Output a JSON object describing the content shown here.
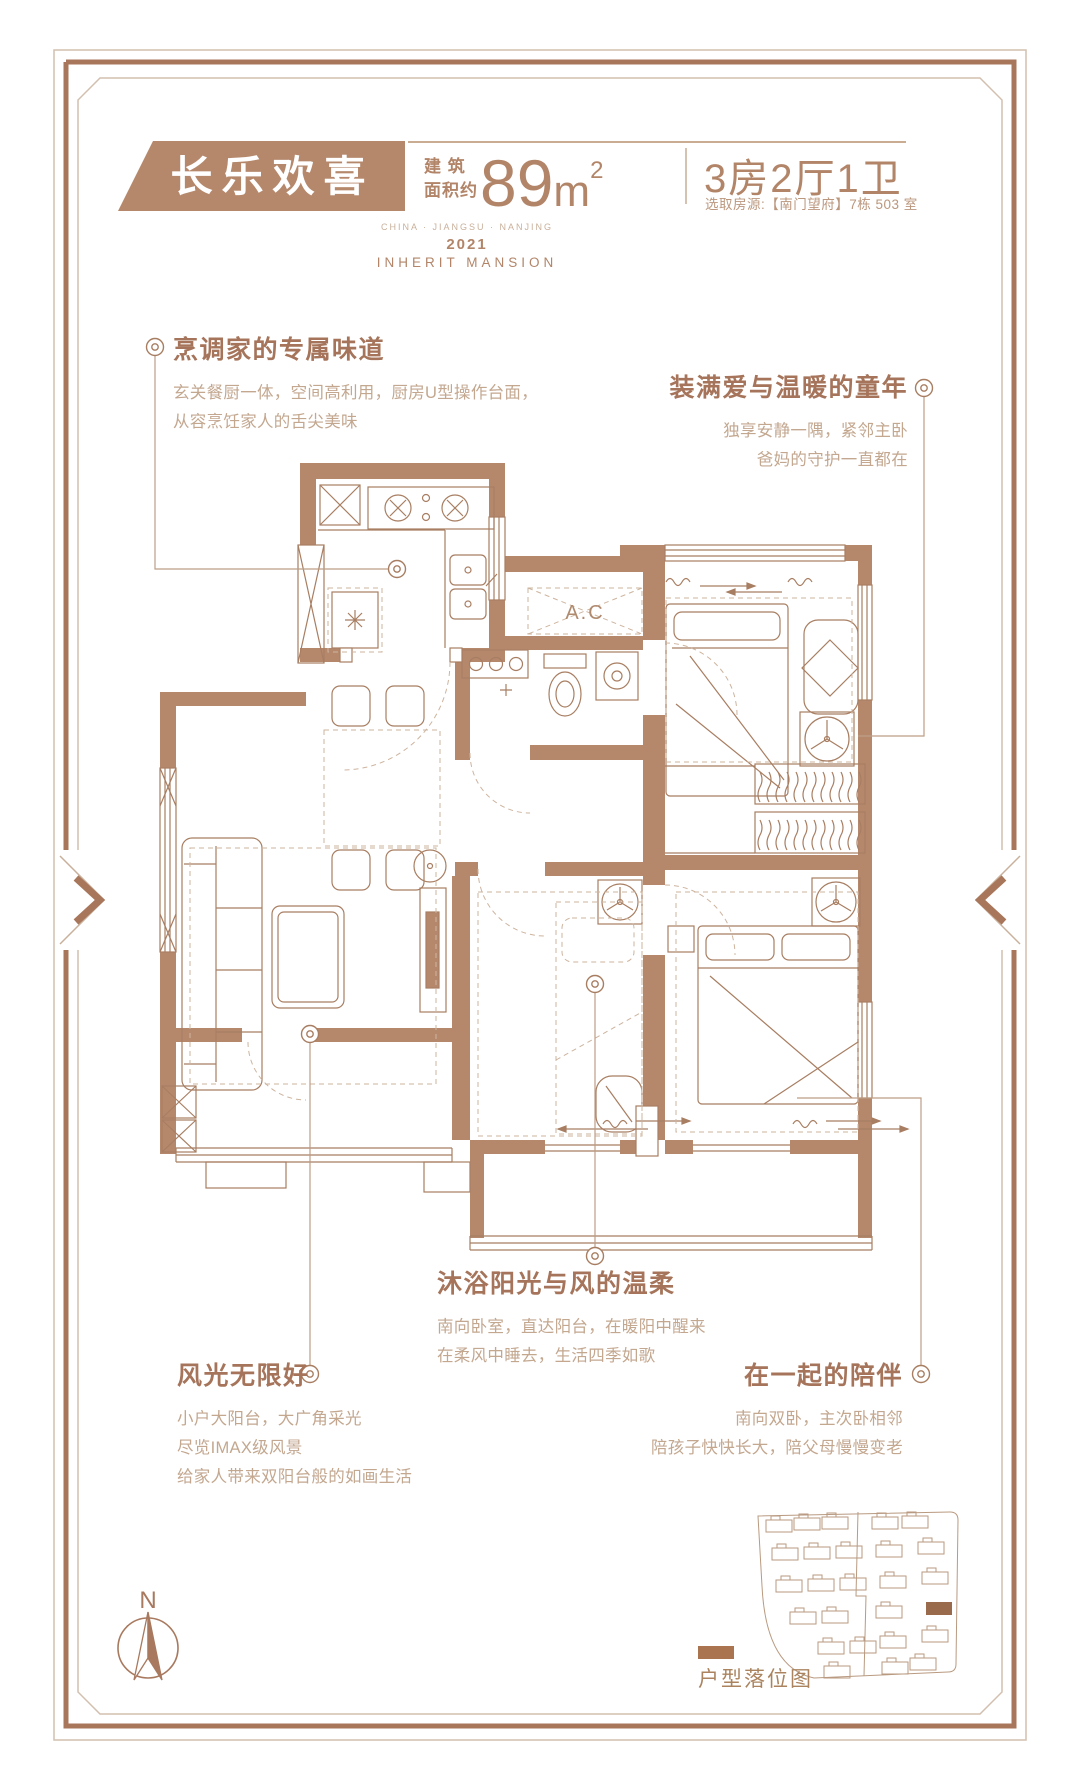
{
  "header": {
    "project_name": "长乐欢喜",
    "area_label_line1": "建 筑",
    "area_label_line2": "面积约",
    "area_value": "89",
    "area_unit": "m",
    "area_sup": "2",
    "layout": "3房2厅1卫",
    "source_note": "选取房源:【南门望府】7栋 503 室",
    "location_en": "CHINA · JIANGSU · NANJING",
    "year": "2021",
    "brand_en": "INHERIT MANSION"
  },
  "annotations": {
    "kitchen": {
      "title": "烹调家的专属味道",
      "lines": [
        "玄关餐厨一体，空间高利用，厨房U型操作台面，",
        "从容烹饪家人的舌尖美味"
      ]
    },
    "children": {
      "title": "装满爱与温暖的童年",
      "lines": [
        "独享安静一隅，紧邻主卧",
        "爸妈的守护一直都在"
      ]
    },
    "sunshine": {
      "title": "沐浴阳光与风的温柔",
      "lines": [
        "南向卧室，直达阳台，在暖阳中醒来",
        "在柔风中睡去，生活四季如歌"
      ]
    },
    "view": {
      "title": "风光无限好",
      "lines": [
        "小户大阳台，大广角采光",
        "尽览IMAX级风景",
        "给家人带来双阳台般的如画生活"
      ]
    },
    "together": {
      "title": "在一起的陪伴",
      "lines": [
        "南向双卧，主次卧相邻",
        "陪孩子快快长大，陪父母慢慢变老"
      ]
    }
  },
  "plan": {
    "ac_label": "A.C",
    "compass_label": "N"
  },
  "legend": {
    "site_label": "户型落位图"
  },
  "colors": {
    "banner": "#b5886c",
    "wall": "#b5886c",
    "line": "#a87e62",
    "title_text": "#a5745a",
    "body_text": "#c3a78f",
    "frame_thick": "#a8765a",
    "frame_thin": "#d2bfae",
    "highlight_building": "#9a6a4c"
  }
}
